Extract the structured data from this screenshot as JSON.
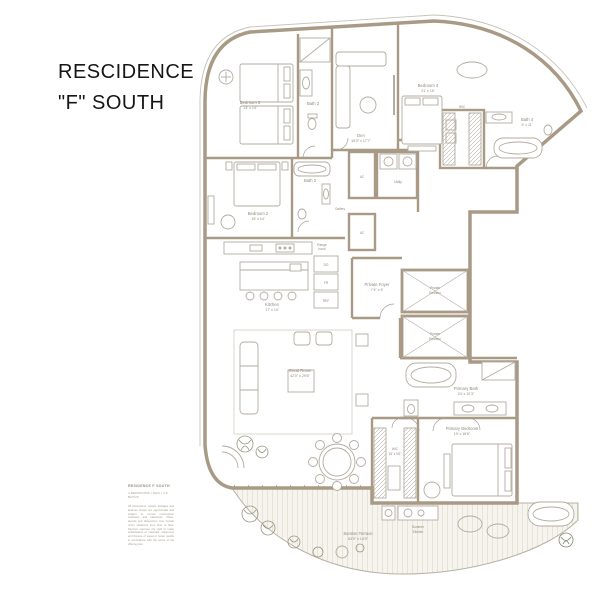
{
  "title": {
    "line1": "RESCIDENCE",
    "line2": "\"F\" SOUTH"
  },
  "colors": {
    "wall": "#a89a85",
    "thin_line": "#c9c3b6",
    "furniture": "#b3aca0",
    "label_text": "#8f897c",
    "deck_stripe": "#e4dfd2",
    "deck_bg": "#f6f4ee",
    "plant": "#97987f",
    "plant_green": "#7d8a6a",
    "title_text": "#161616"
  },
  "rooms": {
    "bedroom3": {
      "name": "Bedroom 3",
      "dims": "14' x 14'"
    },
    "bath3": {
      "name": "Bath 3"
    },
    "den": {
      "name": "Den",
      "dims": "15'0\" x 17'7\""
    },
    "bedroom4": {
      "name": "Bedroom 4",
      "dims": "21' x 15'"
    },
    "wic4": {
      "name": "WIC"
    },
    "bath4": {
      "name": "Bath 4",
      "dims": "5' x 11'"
    },
    "bedroom2": {
      "name": "Bedroom 2",
      "dims": "15' x 14'"
    },
    "bath2": {
      "name": "Bath 2"
    },
    "ac1": {
      "name": "AC"
    },
    "ac2": {
      "name": "AC"
    },
    "utility": {
      "name": "Utility"
    },
    "gallery": {
      "name": "Gallery"
    },
    "range_hood": {
      "line1": "Range",
      "line2": "hood"
    },
    "kitchen": {
      "name": "Kitchen",
      "dims": "17' x 14'"
    },
    "appliances": {
      "do": "DO",
      "fr": "FR",
      "ref": "REF"
    },
    "private_foyer": {
      "name": "Private Foyer",
      "dims": "7'4\" x 9'"
    },
    "elevator1": {
      "line1": "Private",
      "line2": "Elevator"
    },
    "elevator2": {
      "line1": "Private",
      "line2": "Elevator"
    },
    "great_room": {
      "name": "Great Room",
      "dims": "42'0\" x 29'6\""
    },
    "primary_bath": {
      "name": "Primary Bath",
      "dims": "24' x 10'3\""
    },
    "primary_bedroom": {
      "name": "Primary Bedroom",
      "dims": "19' x 16'6\""
    },
    "wic": {
      "name": "WIC",
      "dims": "15' x 9'6\""
    },
    "summer_kitchen": {
      "line1": "Summer",
      "line2": "Kitchen"
    },
    "terrace": {
      "name": "Sunrise Terrace",
      "dims": "63'0\" x 14'9\""
    }
  },
  "legend": {
    "heading": "RESIDENCE F SOUTH",
    "subheading": "4 BEDROOMS | DEN | 4.5 BATHS",
    "disclaimer": "All dimensions, square footages and features shown are approximate and subject to normal construction variances and tolerances. Plans, layouts and dimensions may contain minor variations from floor to floor. Sponsor reserves the right to make substitutions of materials, equipment and fixtures of equal or better quality in accordance with the terms of the offering plan."
  }
}
